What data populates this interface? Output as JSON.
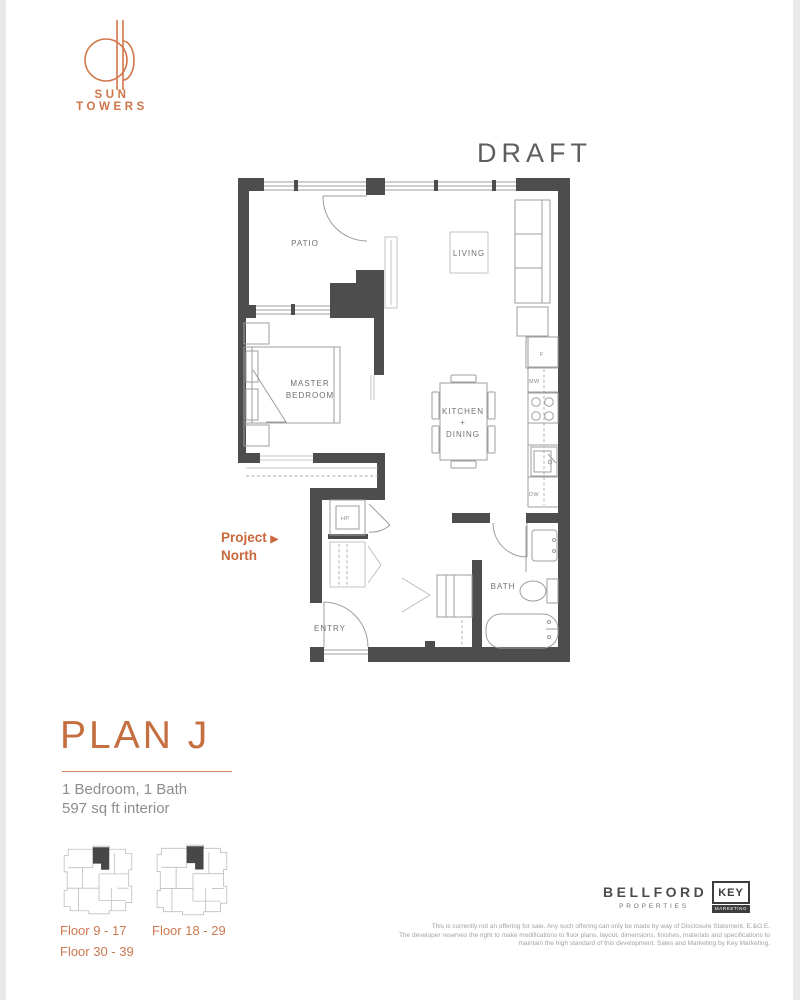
{
  "brand": {
    "name": "SUN TOWERS"
  },
  "draft_label": "DRAFT",
  "plan": {
    "rooms": {
      "patio": "PATIO",
      "living": "LIVING",
      "master_line1": "MASTER",
      "master_line2": "BEDROOM",
      "kitchen_line1": "KITCHEN",
      "kitchen_line2": "+",
      "kitchen_line3": "DINING",
      "bath": "BATH",
      "entry": "ENTRY"
    },
    "appliances": {
      "fridge": "F",
      "microwave": "MW",
      "dishwasher": "DW",
      "heat_pump": "HP"
    },
    "north": {
      "label": "Project",
      "arrow": "▶",
      "direction": "North"
    }
  },
  "summary": {
    "title": "PLAN J",
    "config": "1 Bedroom, 1 Bath",
    "area": "597 sq ft interior"
  },
  "keyplans": {
    "left_line1": "Floor 9 - 17",
    "left_line2": "Floor 30 - 39",
    "right_line1": "Floor 18 - 29"
  },
  "footer": {
    "developer": {
      "part1": "BE",
      "accent": "L",
      "part2": "LFORD",
      "tagline": "PROPERTIES"
    },
    "marketing": {
      "name": "KEY",
      "tagline": "MARKETING"
    },
    "disclaimer_line1": "This is currently not an offering for sale. Any such offering can only be made by way of Disclosure Statement. E.&O.E.",
    "disclaimer_line2": "The developer reserves the right to make modifications to floor plans, layout, dimensions, finishes, materials and specifications to",
    "disclaimer_line3": "maintain the high standard of this development. Sales and Marketing by Key Marketing."
  },
  "colors": {
    "accent": "#cc7347",
    "wall": "#4d4d4d",
    "line": "#9e9e9e",
    "label": "#6f6f6f"
  }
}
